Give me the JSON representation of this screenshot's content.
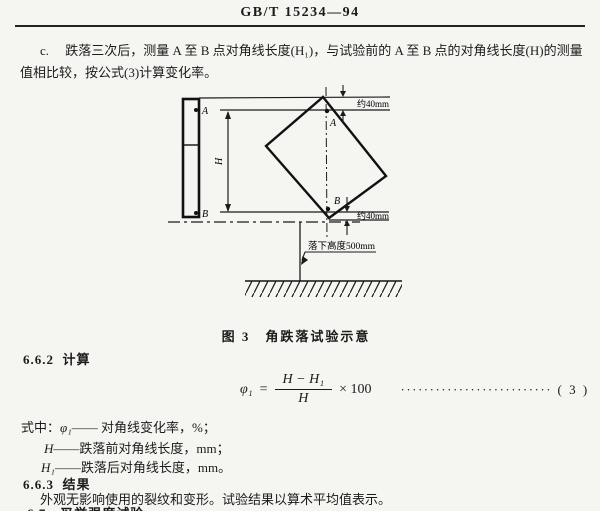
{
  "doc": {
    "header": "GB/T 15234—94",
    "para_c_line1": "c.　 跌落三次后，测量 A 至 B 点对角线长度(H₁)，与试验前的 A 至 B 点的对角线长度(H)的测量",
    "para_c_line2": "值相比较，按公式(3)计算变化率。"
  },
  "figure": {
    "caption": "图 3　角跌落试验示意",
    "label_a_left": "A",
    "label_b_left": "B",
    "label_a_diamond": "A",
    "label_b_diamond": "B",
    "label_h": "H",
    "dim_top": "约40mm",
    "dim_bottom": "约40mm",
    "drop_height_label": "落下高度500mm"
  },
  "calc": {
    "section_num": "6.6.2",
    "section_title": "计算",
    "formula": {
      "lhs": "φ₁",
      "equals": "=",
      "numerator": "H − H₁",
      "denominator": "H",
      "multiplier": "× 100",
      "leader_dots": "························································",
      "eq_number": "( 3 )"
    },
    "where_prefix": "式中：",
    "where_items": [
      {
        "symbol": "φ₁",
        "dash": "——",
        "desc": "对角线变化率，%；"
      },
      {
        "symbol": "H",
        "dash": "——",
        "desc": "跌落前对角线长度，mm；"
      },
      {
        "symbol": "H₁",
        "dash": "——",
        "desc": "跌落后对角线长度，mm。"
      }
    ]
  },
  "result": {
    "section_num": "6.6.3",
    "section_title": "结果",
    "body": "外观无影响使用的裂纹和变形。试验结果以算术平均值表示。",
    "next_section_partial": "6.7　叉举强度试验"
  }
}
